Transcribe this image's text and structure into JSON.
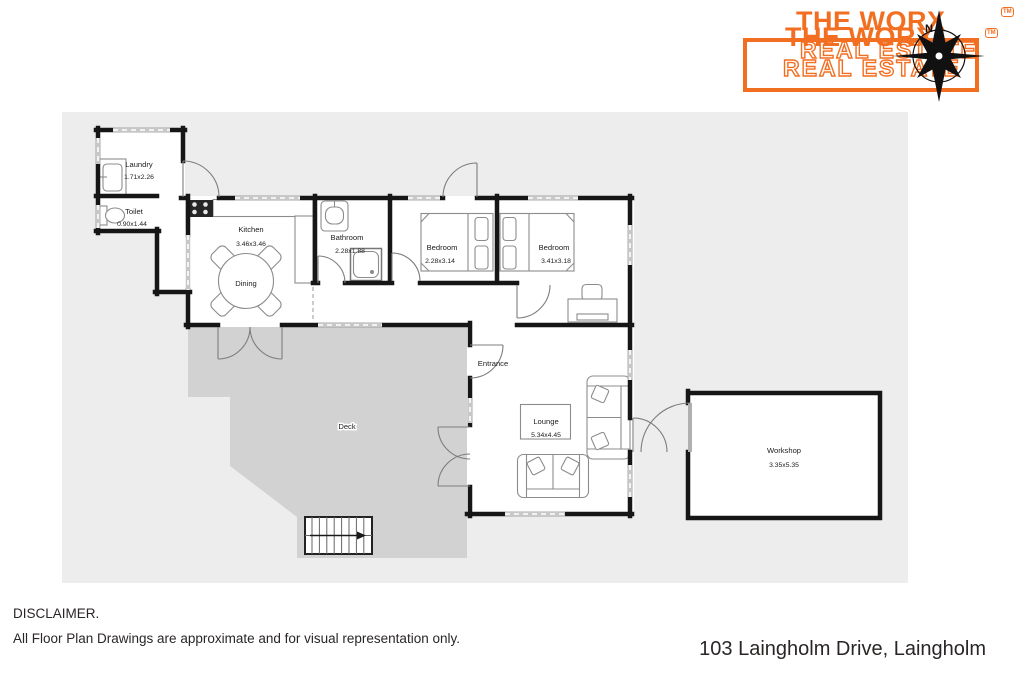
{
  "logo": {
    "title": "THE WORX",
    "subtitle": "REAL ESTATE",
    "tm": "TM",
    "compass_n": "N"
  },
  "plan": {
    "laundry": {
      "name": "Laundry",
      "dims": "1.71x2.26"
    },
    "toilet": {
      "name": "Toilet",
      "dims": "0.90x1.44"
    },
    "kitchen": {
      "name": "Kitchen",
      "dims": "3.46x3.46"
    },
    "dining": {
      "name": "Dining"
    },
    "bathroom": {
      "name": "Bathroom",
      "dims": "2.28x1.88"
    },
    "bedroom1": {
      "name": "Bedroom",
      "dims": "2.28x3.14"
    },
    "bedroom2": {
      "name": "Bedroom",
      "dims": "3.41x3.18"
    },
    "entrance": {
      "name": "Entrance"
    },
    "lounge": {
      "name": "Lounge",
      "dims": "5.34x4.45"
    },
    "deck": {
      "name": "Deck"
    },
    "workshop": {
      "name": "Workshop",
      "dims": "3.35x5.35"
    }
  },
  "footer": {
    "disclaimer_title": "DISCLAIMER.",
    "disclaimer_body": "All Floor Plan Drawings are approximate and for visual representation only.",
    "address": "103 Laingholm Drive, Laingholm"
  },
  "colors": {
    "accent": "#f26f21",
    "wall": "#161616",
    "canvas": "#ededed",
    "deck": "#d2d2d2"
  }
}
